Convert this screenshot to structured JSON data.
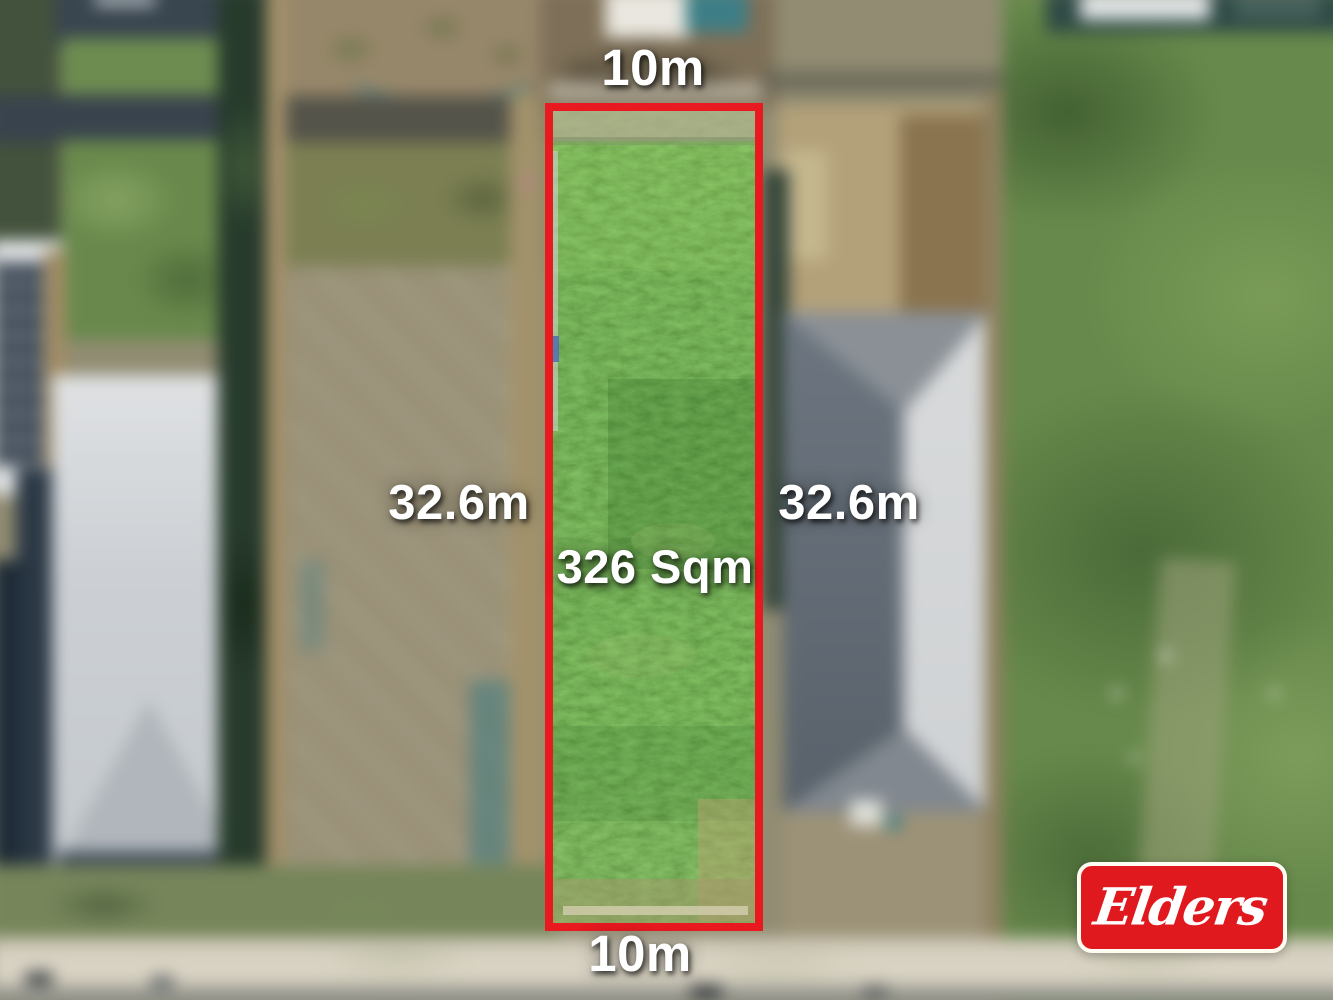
{
  "annotations": {
    "frontage_top": "10m",
    "frontage_bottom": "10m",
    "side_left": "32.6m",
    "side_right": "32.6m",
    "land_area": "326 Sqm"
  },
  "branding": {
    "agency": "Elders"
  },
  "colors": {
    "boundary_outline": "#E8191F",
    "logo_background": "#E0191E",
    "logo_border": "#FFFDF2",
    "annotation_text": "#FFFFFF"
  }
}
